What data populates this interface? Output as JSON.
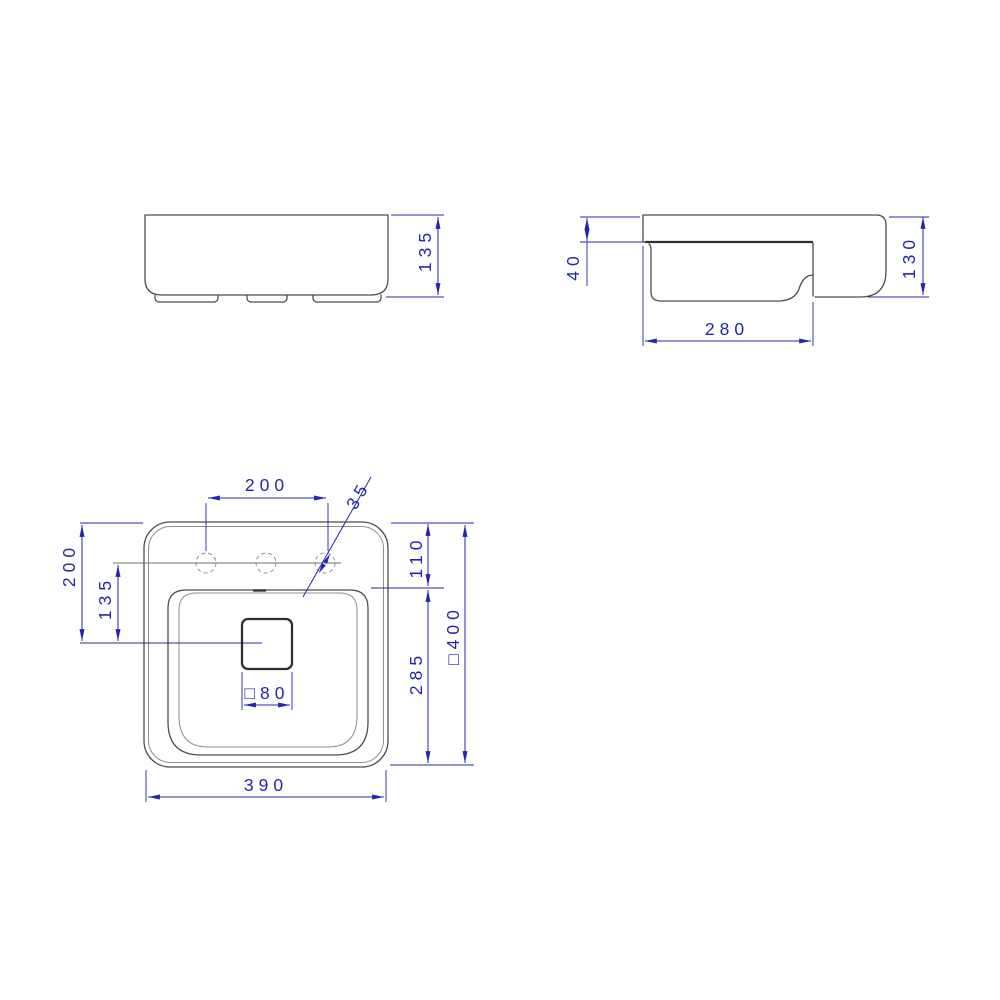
{
  "drawing": {
    "accent_color": "#2424b4",
    "outline_color": "#4d4d4d",
    "dims": {
      "front_height": "135",
      "apron_height": "40",
      "basin_depth": "280",
      "side_height": "130",
      "hole_spacing": "200",
      "hole_diameter": "35",
      "rim_to_bowl": "110",
      "left_depth_to_drain": "200",
      "holes_to_drain": "135",
      "bowl_front_depth": "285",
      "overall_depth": "□400",
      "overall_width": "390",
      "drain_size": "□80"
    }
  }
}
